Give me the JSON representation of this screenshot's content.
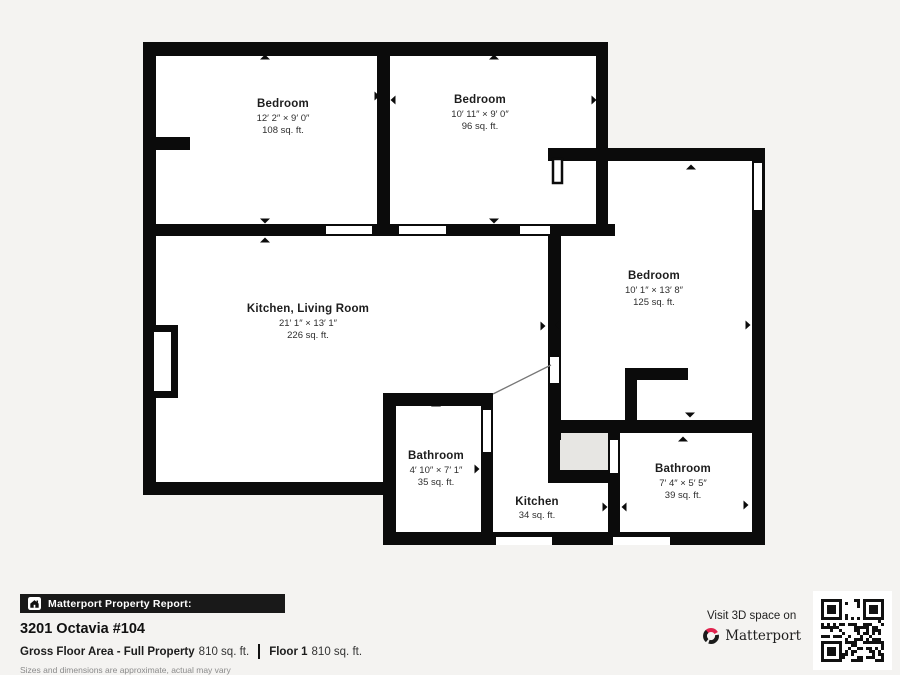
{
  "plan": {
    "rooms": [
      {
        "name": "Bedroom",
        "dims": "12′ 2″ × 9′ 0″",
        "area": "108 sq. ft."
      },
      {
        "name": "Bedroom",
        "dims": "10′ 11″ × 9′ 0″",
        "area": "96 sq. ft."
      },
      {
        "name": "Bedroom",
        "dims": "10′ 1″ × 13′ 8″",
        "area": "125 sq. ft."
      },
      {
        "name": "Kitchen, Living Room",
        "dims": "21′ 1″ × 13′ 1″",
        "area": "226 sq. ft."
      },
      {
        "name": "Bathroom",
        "dims": "4′ 10″ × 7′ 1″",
        "area": "35 sq. ft."
      },
      {
        "name": "Kitchen",
        "area": "34 sq. ft."
      },
      {
        "name": "Bathroom",
        "dims": "7′ 4″ × 5′ 5″",
        "area": "39 sq. ft."
      }
    ]
  },
  "report": {
    "bar_label": "Matterport Property Report:",
    "address": "3201 Octavia #104",
    "gross_label": "Gross Floor Area - Full Property",
    "gross_value": "810 sq. ft.",
    "floor_label": "Floor 1",
    "floor_value": "810 sq. ft.",
    "disclaimer": "Sizes and dimensions are approximate, actual may vary"
  },
  "promo": {
    "visit_text": "Visit 3D space on",
    "brand": "Matterport"
  },
  "icons": {
    "house": "house-icon",
    "arrow": "direction-arrow-icon",
    "logo": "matterport-logo-icon",
    "qr": "qr-code"
  },
  "colors": {
    "background": "#f4f3f1",
    "wall": "#0b0b0b",
    "floor": "#ffffff",
    "shaft": "#e7e6e3",
    "brand_red": "#e0234e",
    "bar_bg": "#191919"
  }
}
